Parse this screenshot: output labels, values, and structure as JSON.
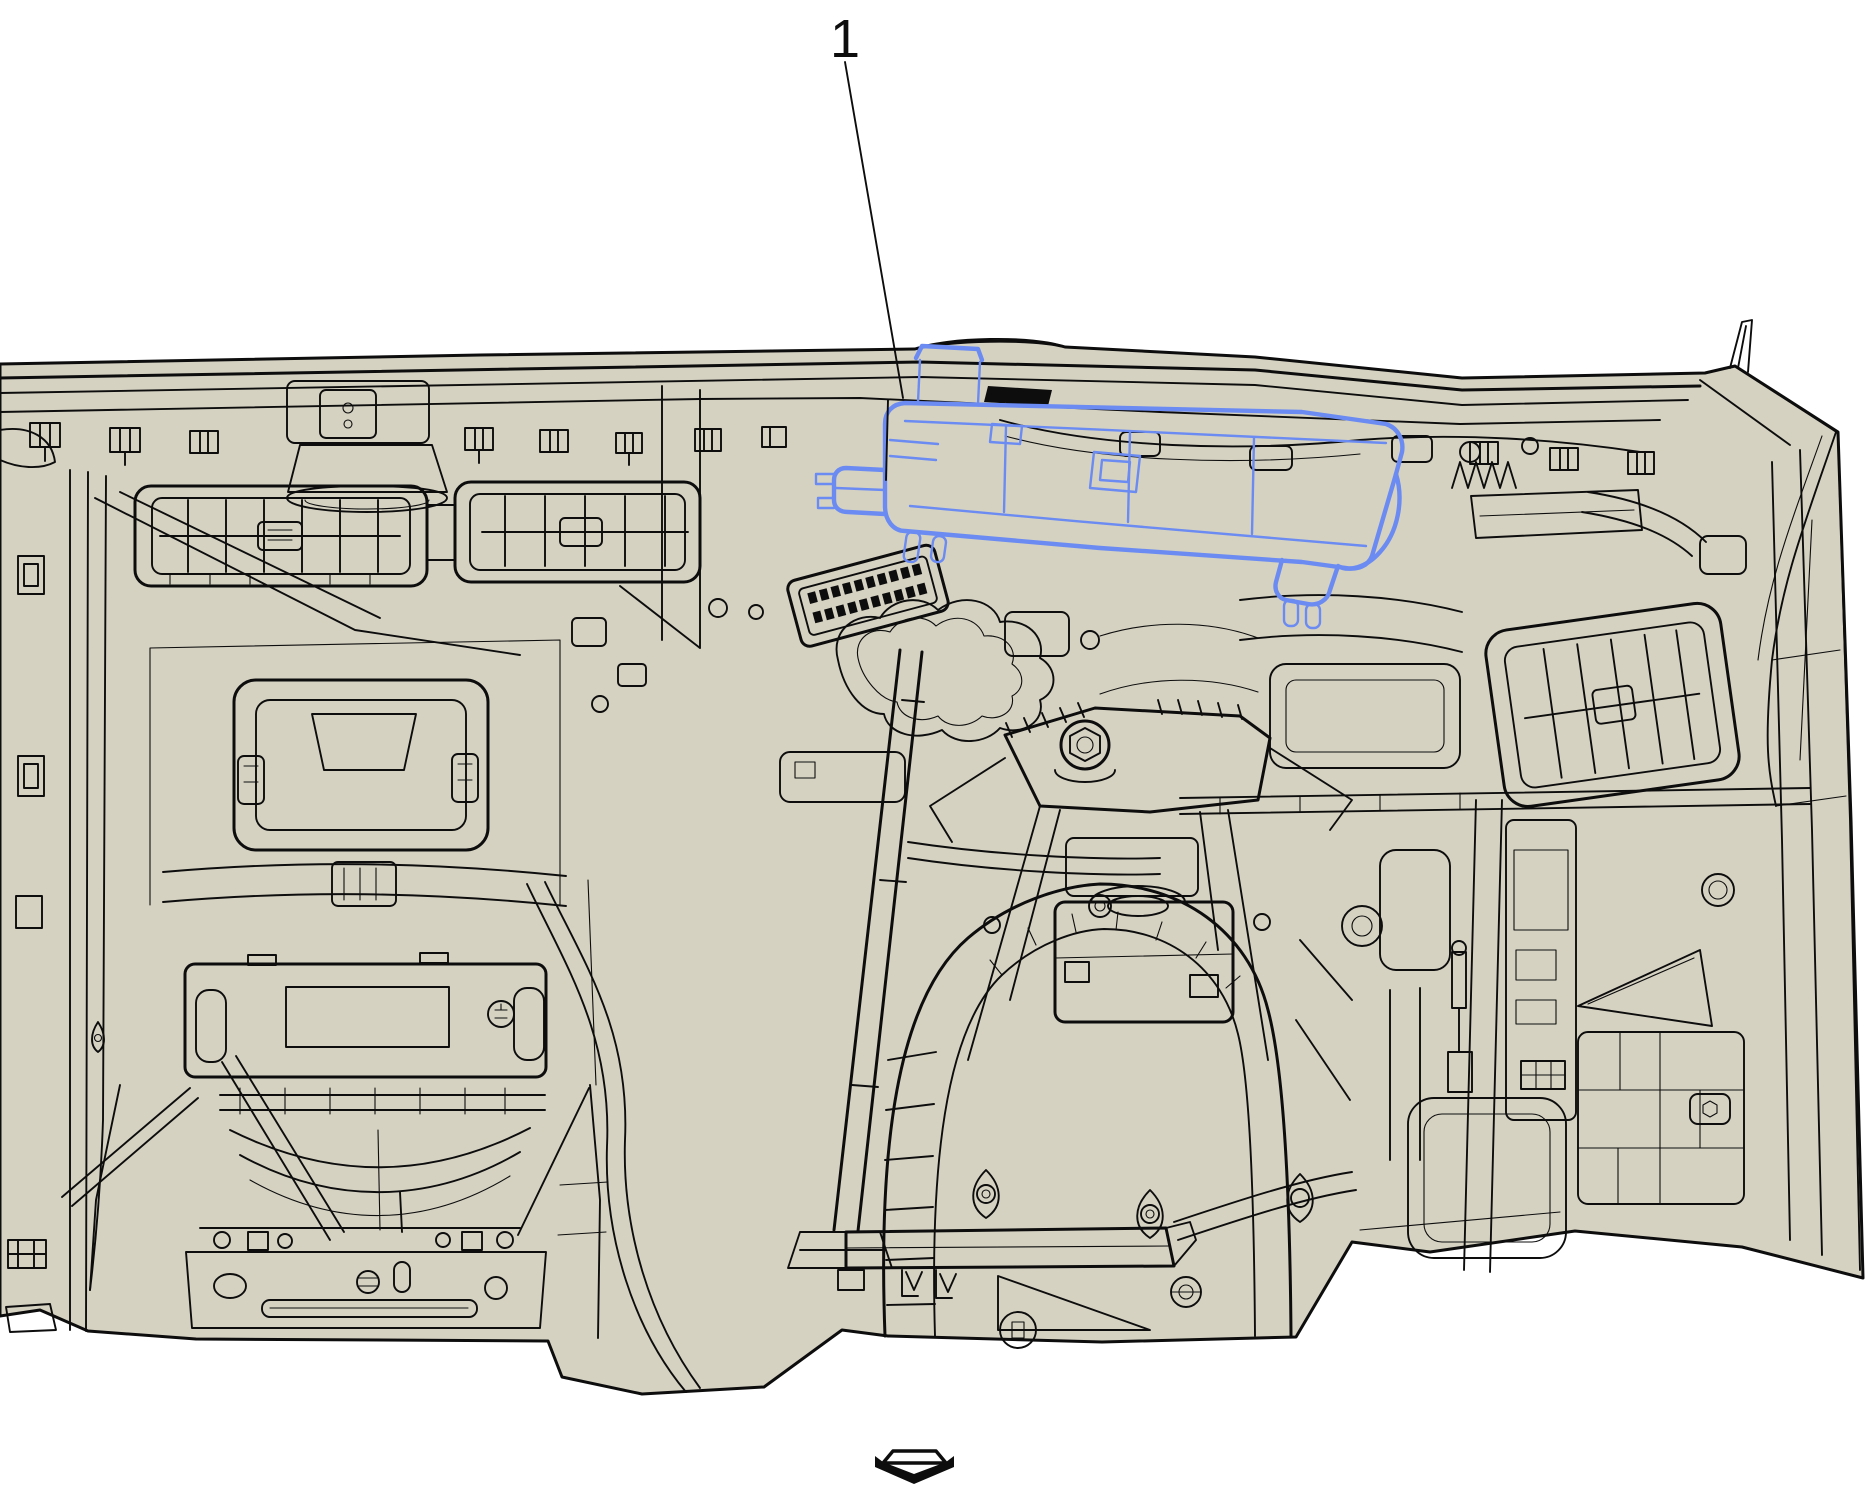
{
  "figure": {
    "callout": {
      "number": "1"
    },
    "colors": {
      "background": "#ffffff",
      "panel": "#d5d2c2",
      "line": "#0d0d0d",
      "highlight": "#6b8bf2"
    },
    "icons": {
      "footer": "continuation-arrow-down-icon"
    }
  }
}
